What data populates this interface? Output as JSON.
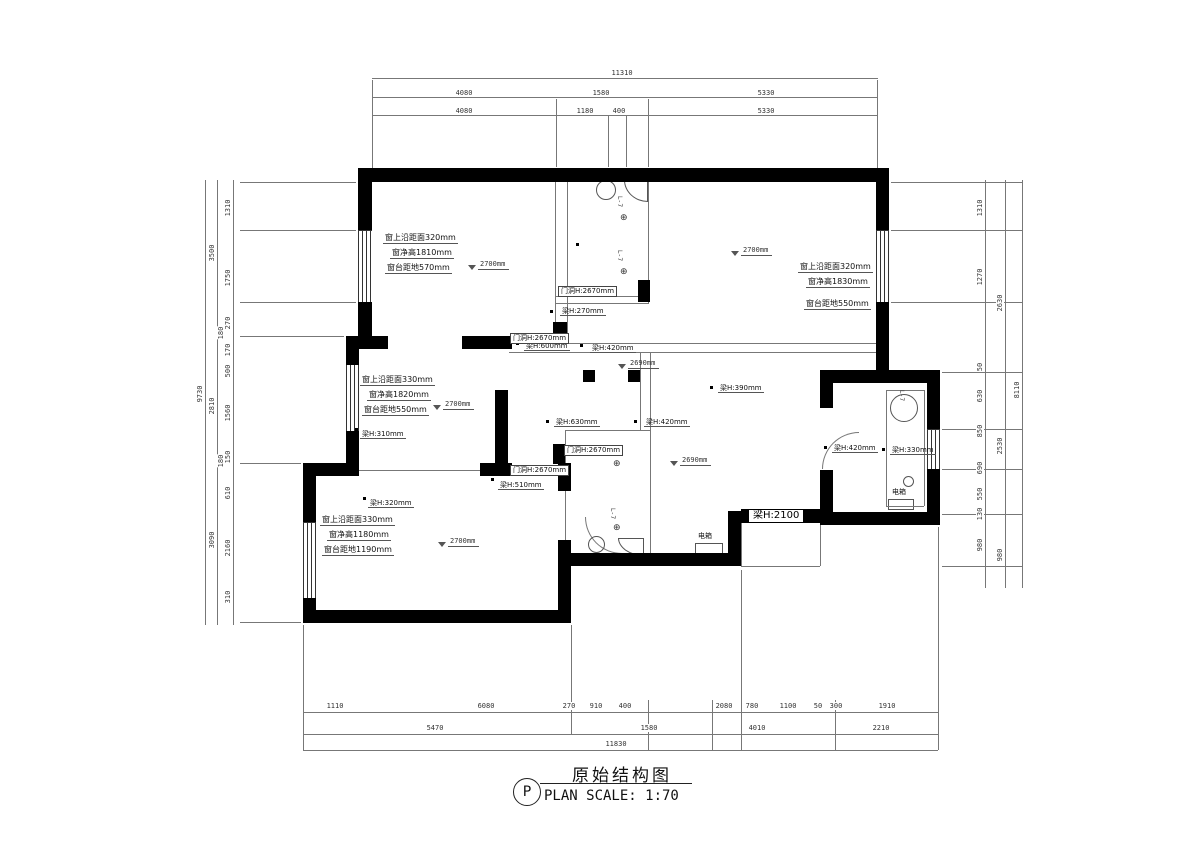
{
  "drawing": {
    "title_tag": "P",
    "title_cn": "原始结构图",
    "title_en": "PLAN   SCALE: 1:70"
  },
  "dims": {
    "top": {
      "overall": "11310",
      "tier2": [
        "4080",
        "1580",
        "5330"
      ],
      "tier3": [
        "4080",
        "1180",
        "400",
        "5330"
      ]
    },
    "bottom": {
      "tier1": [
        "1110",
        "6080",
        "270",
        "910",
        "400",
        "2080",
        "780",
        "1100",
        "50",
        "300",
        "1910"
      ],
      "tier2": [
        "5470",
        "1580",
        "4010",
        "2210"
      ],
      "overall": "11830"
    },
    "left": {
      "overall": "9730",
      "mid": [
        "3500",
        "2810",
        "3090"
      ],
      "inner": [
        "1310",
        "1750",
        "270",
        "170",
        "500",
        "1560",
        "150",
        "610",
        "2160",
        "310"
      ],
      "leaders": [
        "180",
        "180"
      ]
    },
    "right": {
      "overall": "8110",
      "mid": [
        "2630",
        "2530",
        "980"
      ],
      "inner": [
        "1310",
        "1270",
        "50",
        "630",
        "850",
        "690",
        "550",
        "130",
        "980"
      ]
    }
  },
  "windows": [
    {
      "l1": "窗上沿距面320mm",
      "l2": "窗净高1810mm",
      "l3": "窗台距地570mm"
    },
    {
      "l1": "窗上沿距面320mm",
      "l2": "窗净高1830mm",
      "l3": "窗台距地550mm"
    },
    {
      "l1": "窗上沿距面330mm",
      "l2": "窗净高1820mm",
      "l3": "窗台距地550mm"
    },
    {
      "l1": "窗上沿距面330mm",
      "l2": "窗净高1180mm",
      "l3": "窗台距地1190mm"
    }
  ],
  "ceilings": [
    "2700mm",
    "2700mm",
    "2700mm",
    "2700mm",
    "2690mm",
    "2690mm"
  ],
  "beams": {
    "b270": "梁H:270mm",
    "b600": "梁H:600mm",
    "b420": "梁H:420mm",
    "b310": "梁H:310mm",
    "b320": "梁H:320mm",
    "b510": "梁H:510mm",
    "b630": "梁H:630mm",
    "b390": "梁H:390mm",
    "b330": "梁H:330mm",
    "b2100": "梁H:2100"
  },
  "openings": {
    "door": "门洞H:2670mm"
  },
  "labels": {
    "electrical": "电箱",
    "riser": "L-7"
  }
}
